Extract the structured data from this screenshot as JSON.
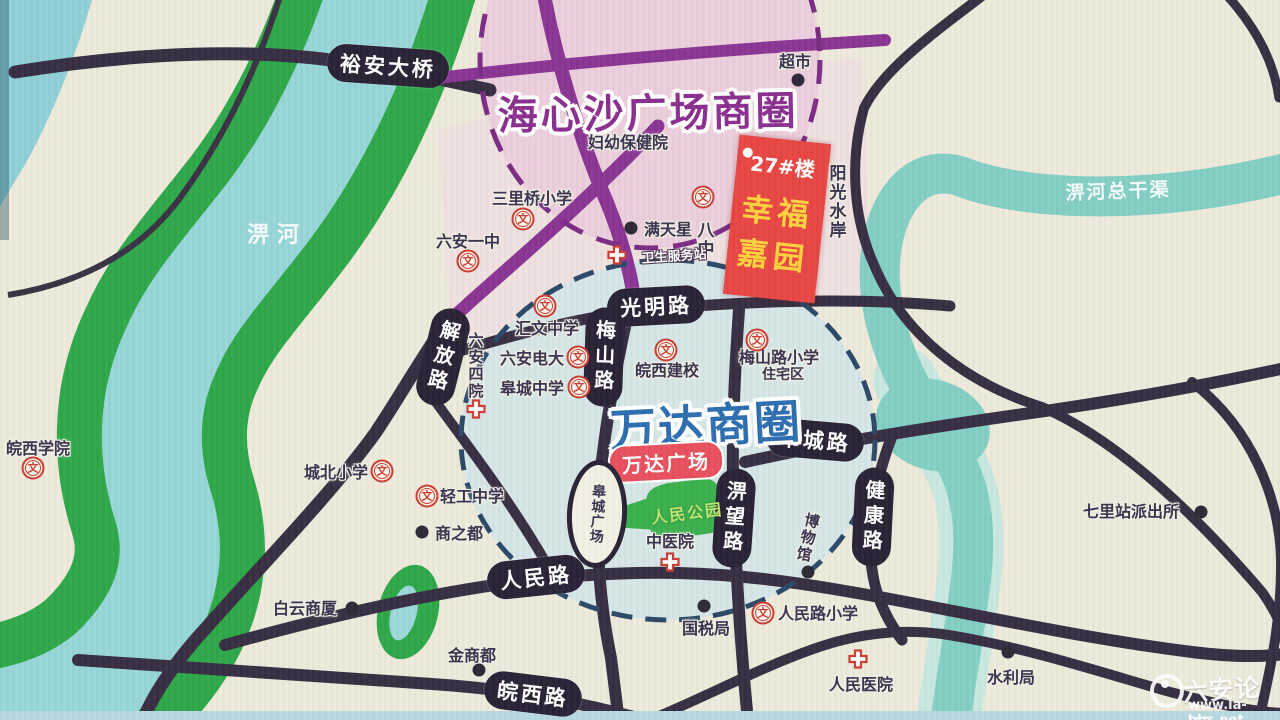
{
  "colors": {
    "background": "#eeeadb",
    "river": "#97d6d8",
    "canal": "#85cfc5",
    "greenbelt": "#2fa84a",
    "road_dark": "#382f42",
    "road_purple": "#8b3594",
    "pill_bg": "#2a2436",
    "pink_circle_fill": "#eccfdc",
    "blue_circle_fill": "#d4e6e8",
    "pink_circle_dash": "#7b2d85",
    "blue_circle_dash": "#2c4a68",
    "banner_red": "#e84744",
    "banner_yellow": "#ffd23e",
    "plaza_red": "#e8515e",
    "park_green": "#3bb04d",
    "school_icon_red": "#cc3f35",
    "text_dark": "#3a3450"
  },
  "titles": {
    "haixinsha": "海心沙广场商圈",
    "wanda": "万达商圈"
  },
  "property": {
    "building_no": "27#楼",
    "name_line1": "幸福",
    "name_line2": "嘉园"
  },
  "roads": {
    "yuan_bridge": "裕安大桥",
    "jiefang": "解放路",
    "meishan": "梅山路",
    "guangming": "光明路",
    "gaocheng": "皋城路",
    "piwang": "淠望路",
    "jiankang": "健康路",
    "renmin": "人民路",
    "wanxi": "皖西路"
  },
  "rivers": {
    "pihe": "淠河",
    "canal": "淠河总干渠"
  },
  "pois": {
    "supermarket": "超市",
    "maternal_child_hospital": "妇幼保健院",
    "sunshine_waterfront": "阳光水岸",
    "sanliqiao_primary": "三里桥小学",
    "luan_no1_middle": "六安一中",
    "mantianxing": "满天星",
    "no8_middle": "八中",
    "health_station": "卫生服务站",
    "huiwen_middle": "汇文中学",
    "luan_tv_university": "六安电大",
    "gaocheng_middle": "皋城中学",
    "luan_no4_hospital": "六安四院",
    "wanxi_construction_school": "皖西建校",
    "meishanlu_primary": "梅山路小学",
    "residential_area": "住宅区",
    "wanda_plaza": "万达广场",
    "gaocheng_square": "皋城广场",
    "peoples_park": "人民公园",
    "chengbei_primary": "城北小学",
    "qinggong_middle": "轻工中学",
    "shangzhidu": "商之都",
    "baiyun_building": "白云商厦",
    "jinshangdu": "金商都",
    "tax_bureau": "国税局",
    "renminlu_primary": "人民路小学",
    "tcm_hospital": "中医院",
    "museum": "博物馆",
    "renmin_hospital": "人民医院",
    "water_bureau": "水利局",
    "qilizhan_police": "七里站派出所",
    "wanxi_college": "皖西学院"
  },
  "icons": {
    "school_glyph": "文"
  },
  "watermark": {
    "site_name": "六安论坛",
    "site_url": "www.la-bbs.net"
  }
}
